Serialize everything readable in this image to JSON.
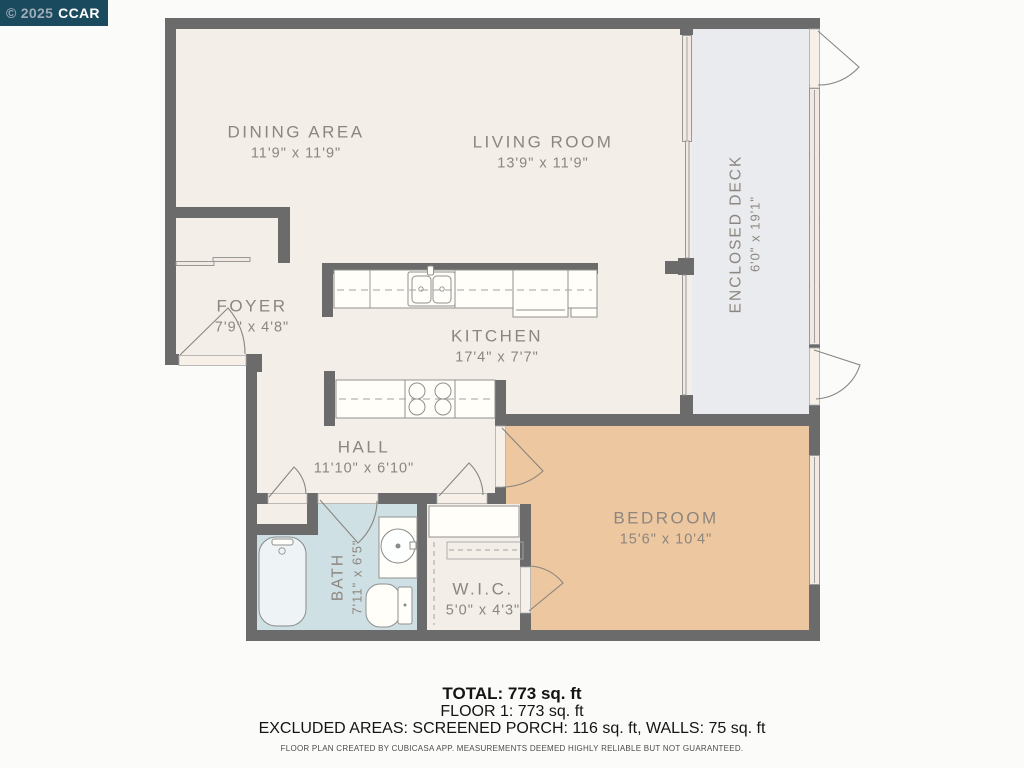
{
  "watermark": {
    "year": "© 2025",
    "brand": "CCAR"
  },
  "rooms": [
    {
      "key": "dining",
      "name": "DINING AREA",
      "dims": "11'9\" x 11'9\""
    },
    {
      "key": "living",
      "name": "LIVING ROOM",
      "dims": "13'9\" x 11'9\""
    },
    {
      "key": "deck",
      "name": "ENCLOSED DECK",
      "dims": "6'0\" x 19'1\""
    },
    {
      "key": "foyer",
      "name": "FOYER",
      "dims": "7'9\" x 4'8\""
    },
    {
      "key": "kitchen",
      "name": "KITCHEN",
      "dims": "17'4\" x 7'7\""
    },
    {
      "key": "hall",
      "name": "HALL",
      "dims": "11'10\" x 6'10\""
    },
    {
      "key": "bath",
      "name": "BATH",
      "dims": "7'11\" x 6'5\""
    },
    {
      "key": "wic",
      "name": "W.I.C.",
      "dims": "5'0\" x 4'3\""
    },
    {
      "key": "bedroom",
      "name": "BEDROOM",
      "dims": "15'6\" x 10'4\""
    }
  ],
  "summary": {
    "total": "TOTAL: 773 sq. ft",
    "floor1": "FLOOR 1: 773 sq. ft",
    "excluded": "EXCLUDED AREAS: SCREENED PORCH: 116 sq. ft, WALLS: 75 sq. ft",
    "disclaimer": "FLOOR PLAN CREATED BY CUBICASA APP. MEASUREMENTS DEEMED HIGHLY RELIABLE BUT NOT GUARANTEED."
  },
  "colors": {
    "wall": "#6c6b6c",
    "floor_main": "#f4eee8",
    "floor_deck": "#eaebee",
    "floor_bedroom": "#edc79f",
    "floor_bath": "#cfe0e4",
    "watermark_bg": "#1a4a5e"
  }
}
